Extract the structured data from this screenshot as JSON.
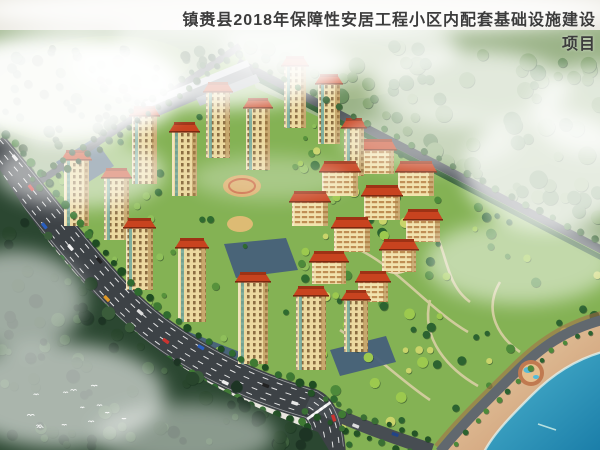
{
  "header": {
    "title": "镇赉县2018年保障性安居工程小区内配套基础设施建设项目"
  },
  "palette": {
    "sky": "#e9e7df",
    "backdrop_green": "#9cb489",
    "hill_light": "#a9c28b",
    "hill_mid": "#8fae72",
    "lawn": "#84b254",
    "dark_forest": "#2b4731",
    "road_main": "#3d4246",
    "road_secondary": "#53595f",
    "road_branch": "#474d52",
    "road_shore": "#61686e",
    "hedge": "#2e5a33",
    "roof": "#c8431f",
    "roof_dark": "#9e3215",
    "facade": "#ecd9a0",
    "facade_mid": "#f2e3ae",
    "long_building_roof": "#70777d",
    "long_building_top": "#ccd1d5",
    "parking": "#46607a",
    "sand_light": "#ecd9b0",
    "sand_dark": "#c9906a",
    "beach_trim": "#aa6a45",
    "water_light": "#4fb6d0",
    "water_deep": "#1a7da8",
    "fog": "#ffffff",
    "title_color": "#3c3c3c"
  },
  "scene": {
    "towers": [
      [
        284,
        66,
        22,
        62
      ],
      [
        318,
        84,
        22,
        60
      ],
      [
        206,
        92,
        24,
        66
      ],
      [
        246,
        108,
        24,
        62
      ],
      [
        344,
        128,
        20,
        48
      ],
      [
        132,
        116,
        25,
        68
      ],
      [
        172,
        132,
        25,
        64
      ],
      [
        64,
        160,
        25,
        66
      ],
      [
        104,
        178,
        25,
        62
      ],
      [
        126,
        228,
        27,
        62
      ],
      [
        178,
        248,
        28,
        74
      ],
      [
        238,
        282,
        30,
        82
      ],
      [
        296,
        296,
        30,
        74
      ],
      [
        344,
        300,
        24,
        52
      ]
    ],
    "slabs": [
      [
        356,
        150,
        38,
        24
      ],
      [
        398,
        172,
        36,
        24
      ],
      [
        322,
        172,
        36,
        24
      ],
      [
        364,
        196,
        36,
        24
      ],
      [
        406,
        220,
        34,
        22
      ],
      [
        292,
        202,
        36,
        24
      ],
      [
        334,
        228,
        36,
        24
      ],
      [
        382,
        250,
        34,
        22
      ],
      [
        312,
        262,
        34,
        22
      ],
      [
        358,
        282,
        30,
        20
      ]
    ],
    "parking_lots": [
      "M56,162 L94,138 L114,166 L76,190 Z",
      "M224,244 L286,238 L298,270 L236,278 Z",
      "M138,312 L240,352 L228,378 L126,338 Z",
      "M330,350 L386,336 L396,362 L340,376 Z"
    ],
    "cars_main": [
      [
        0.05,
        -10,
        "#e8e8e8"
      ],
      [
        0.12,
        -3.5,
        "#cc3430"
      ],
      [
        0.2,
        10,
        "#2a5fc0"
      ],
      [
        0.27,
        3.5,
        "#f0f0f0"
      ],
      [
        0.33,
        -10,
        "#222222"
      ],
      [
        0.4,
        10,
        "#e09a28"
      ],
      [
        0.47,
        -3.5,
        "#dddddd"
      ],
      [
        0.55,
        3.5,
        "#cc3430"
      ],
      [
        0.62,
        -10,
        "#2a5fc0"
      ],
      [
        0.7,
        10,
        "#eeeeee"
      ],
      [
        0.78,
        -3.5,
        "#222222"
      ],
      [
        0.85,
        3.5,
        "#e8e8e8"
      ],
      [
        0.93,
        -10,
        "#cc3430"
      ]
    ],
    "cars_branch": [
      [
        0.4,
        3,
        "#dddddd"
      ],
      [
        0.7,
        -3,
        "#224488"
      ]
    ],
    "birds_count": 13,
    "beach_people_count": 24
  }
}
